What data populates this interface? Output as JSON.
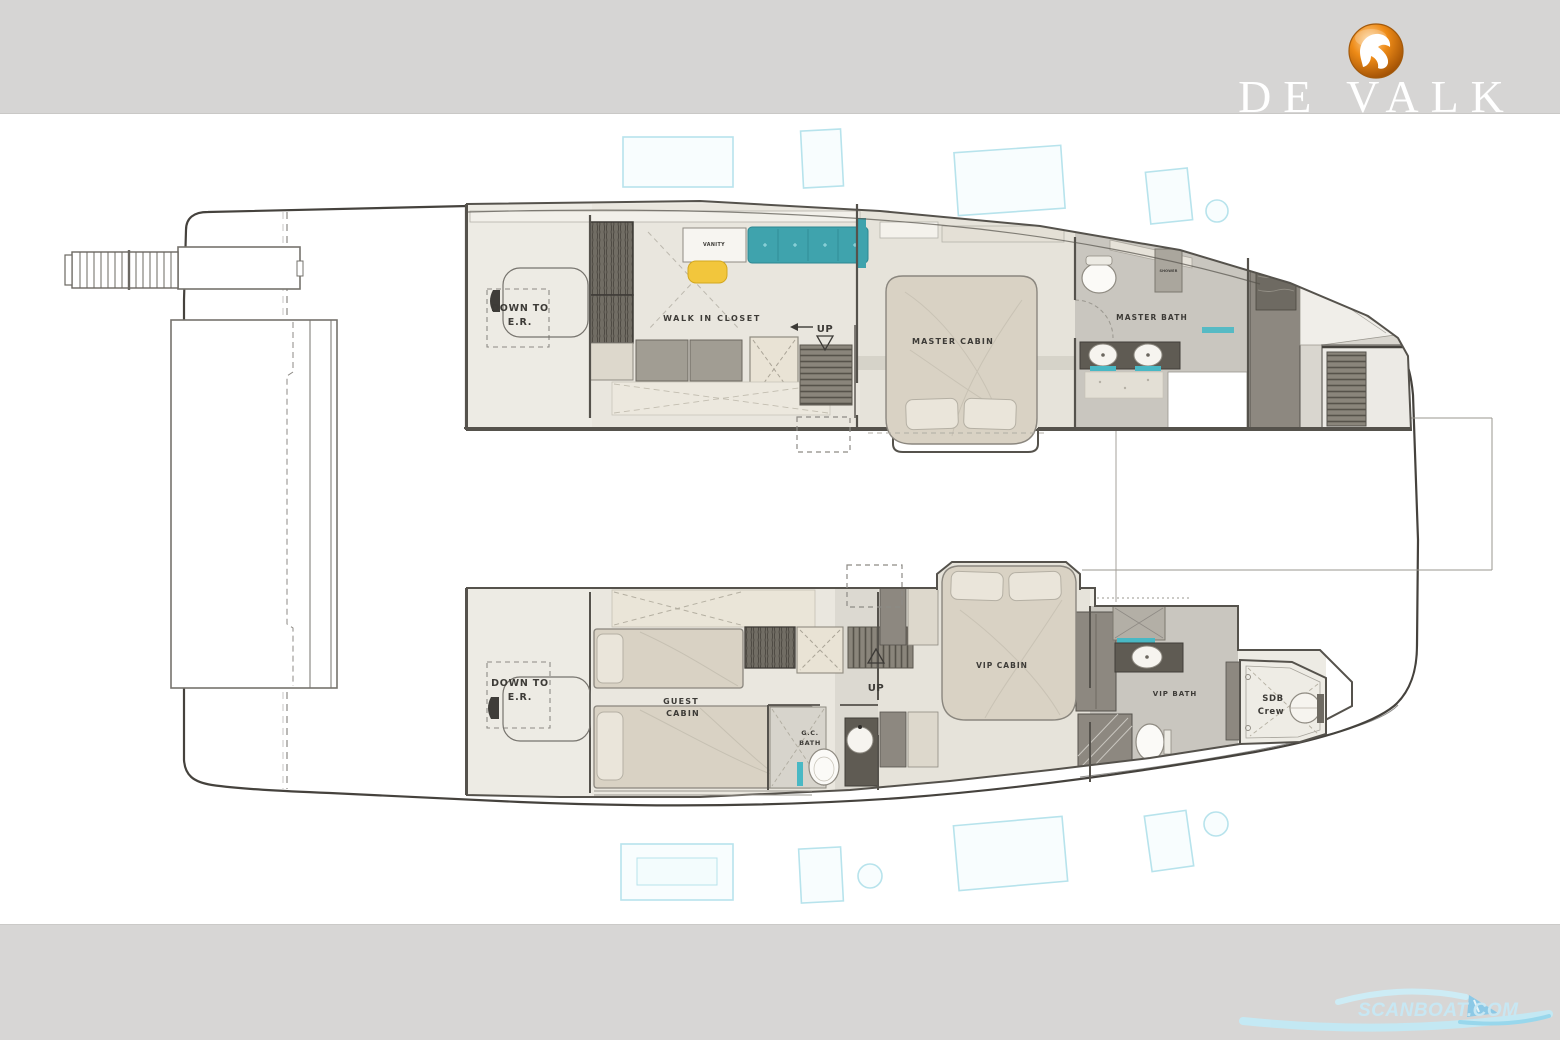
{
  "branding": {
    "logo_text": "DE VALK",
    "logo_icon": "falcon-in-orange-circle",
    "logo_orange": "#ee8b17",
    "watermark_text": "SCANBOAT.COM",
    "watermark_blue": "#bfe6f5"
  },
  "plan": {
    "type": "yacht-lower-deck-floorplan",
    "labels": {
      "down_to": "DOWN TO",
      "er": "E.R.",
      "walk_in_closet": "WALK IN CLOSET",
      "vanity": "VANITY",
      "up": "UP",
      "master_cabin": "MASTER CABIN",
      "master_bath": "MASTER BATH",
      "shower": "SHOWER",
      "guest": "GUEST",
      "cabin": "CABIN",
      "gc": "G.C.",
      "bath": "BATH",
      "vip_cabin": "VIP CABIN",
      "vip_bath": "VIP BATH",
      "sdb": "SDB",
      "crew": "Crew"
    },
    "colors": {
      "band_gray": "#d6d5d4",
      "wall": "#55524c",
      "floor_light": "#edebe4",
      "floor_gray": "#c9c6bf",
      "bed": "#d9d2c4",
      "pillow": "#eae5da",
      "wardrobe_dark": "#716d64",
      "counter_dark": "#5f5b53",
      "stairs_gray": "#8a857b",
      "sofa_teal": "#3fa3ad",
      "stool_yellow": "#f2c63c",
      "accent_teal": "#49b8c4",
      "hatch_cyan": "#b7e3ec"
    }
  }
}
